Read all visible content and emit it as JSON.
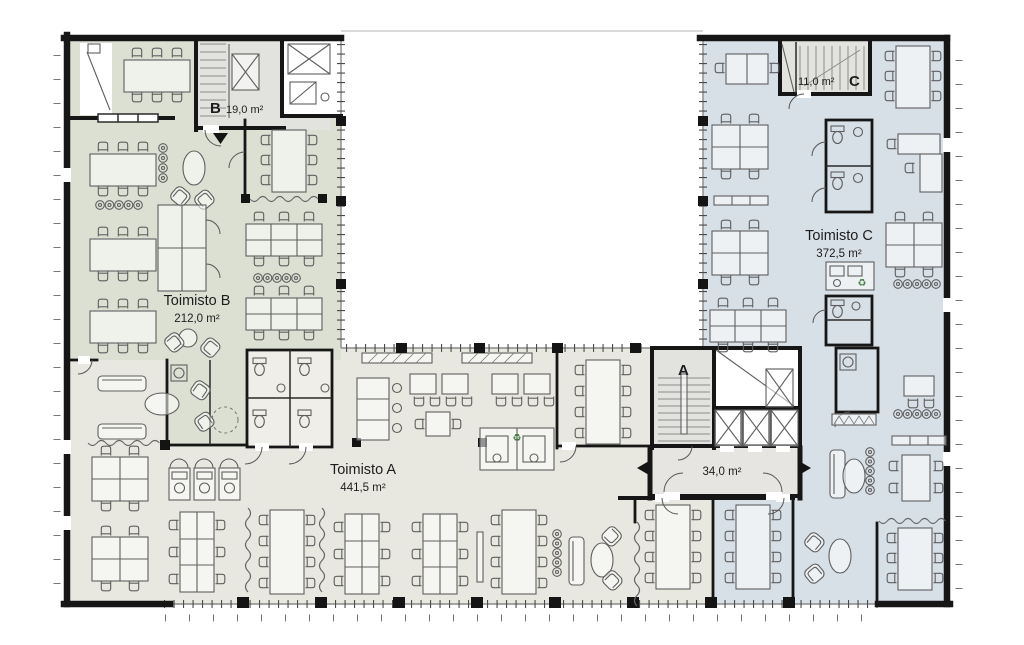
{
  "document": {
    "type": "architectural floor plan",
    "language": "Finnish"
  },
  "colors": {
    "paper": "#ffffff",
    "office_a": "#e9e8e0",
    "office_b": "#dbe0d3",
    "office_c": "#d7dfe7",
    "core": "#e2e2df",
    "lobby": "#e6e5e2",
    "wc_block": "#efeee8",
    "wall": "#161616",
    "furniture_line": "#5f5f5f",
    "recycle_green": "#3f7d3f",
    "text": "#1d1d1d"
  },
  "rooms": {
    "toimisto_a": {
      "label": "Toimisto A",
      "area": "441,5 m²"
    },
    "toimisto_b": {
      "label": "Toimisto B",
      "area": "212,0 m²"
    },
    "toimisto_c": {
      "label": "Toimisto C",
      "area": "372,5 m²"
    },
    "stairwell_b": {
      "label": "B",
      "area": "19,0 m²"
    },
    "stairwell_c": {
      "label": "C",
      "area": "11,0 m²"
    },
    "stairwell_a": {
      "label": "A"
    },
    "entrance_lobby": {
      "area": "34,0 m²"
    }
  },
  "icons": {
    "recycle": "♻"
  }
}
